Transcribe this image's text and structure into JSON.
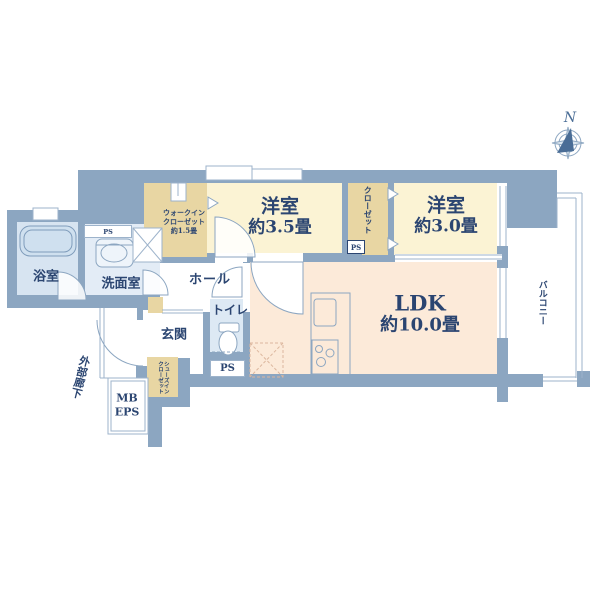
{
  "title": "apartment-floor-plan",
  "compass": {
    "north_label": "N"
  },
  "colors": {
    "wall": "#8ca6c1",
    "thin_line": "#9db3cb",
    "bath_fill": "#d7e4f1",
    "washroom_fill": "#e3ecf6",
    "toilet_fill": "#dde9f4",
    "western_room_fill": "#fbf3d4",
    "closet_fill": "#e8d6a3",
    "ldk_fill": "#fcead9",
    "text_navy": "#2b4571"
  },
  "rooms": {
    "bath": {
      "label": "浴室"
    },
    "washroom": {
      "label": "洗面室"
    },
    "walk_in_closet": {
      "line1": "ウォークイン",
      "line2": "クローゼット",
      "line3": "約1.5畳"
    },
    "hall": {
      "label": "ホール"
    },
    "toilet": {
      "label": "トイレ"
    },
    "entrance": {
      "label": "玄関"
    },
    "western_room_35": {
      "name": "洋室",
      "size": "約3.5畳"
    },
    "closet": {
      "label": "クローゼット"
    },
    "western_room_30": {
      "name": "洋室",
      "size": "約3.0畳"
    },
    "ldk": {
      "name": "LDK",
      "size": "約10.0畳"
    },
    "balcony": {
      "label": "バルコニー"
    },
    "shoes_closet": {
      "label": "シューズインクローゼット"
    },
    "outer_corridor": {
      "label": "外部廊下"
    },
    "mb_eps": {
      "line1": "MB",
      "line2": "EPS"
    }
  },
  "ps_labels": {
    "washroom_ps": "PS",
    "closet_ps": "PS",
    "toilet_ps": "PS"
  }
}
